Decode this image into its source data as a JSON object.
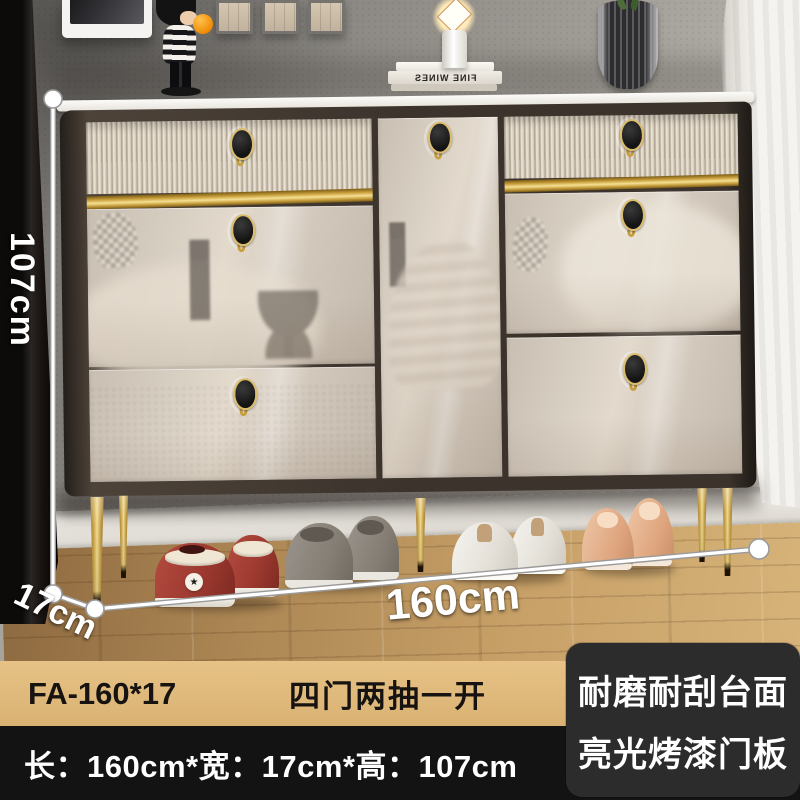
{
  "annotations": {
    "height": "107cm",
    "depth": "17cm",
    "width": "160cm"
  },
  "footer": {
    "model": "FA-160*17",
    "config": "四门两抽一开",
    "size_text": "长：160cm*宽：17cm*高：107cm"
  },
  "badge": {
    "line1": "耐磨耐刮台面",
    "line2": "亮光烤漆门板"
  },
  "decor": {
    "book_spine": "FINE WINES",
    "star": "★"
  },
  "colors": {
    "gold_accent": "#d4a94e",
    "cabinet_beige": "#d7cec3",
    "cabinet_frame": "#3b332c",
    "tan_bar": "#ddb678",
    "black_bar": "#131313",
    "badge_bg": "#2c2c2c",
    "wall_gray": "#9a968f",
    "floor_wood": "#c7a067"
  }
}
